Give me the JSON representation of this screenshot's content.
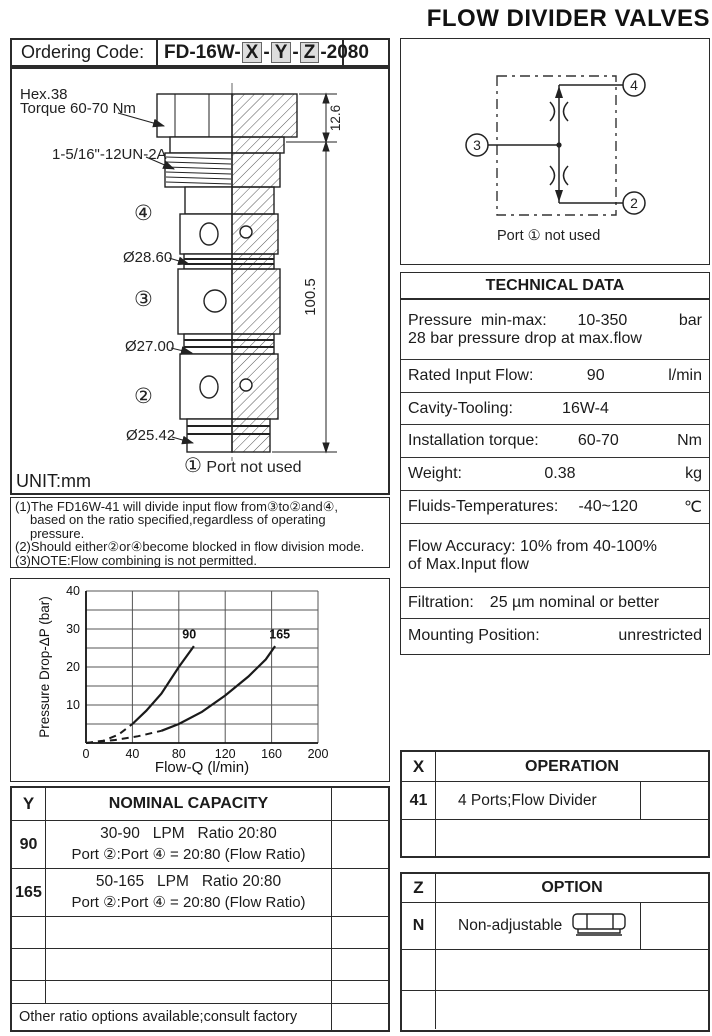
{
  "page_title": "FLOW DIVIDER VALVES",
  "ordering": {
    "label": "Ordering Code:",
    "prefix": "FD-16W-",
    "x": "X",
    "y": "Y",
    "z": "Z",
    "dash": "-",
    "suffix": "-2080"
  },
  "drawing": {
    "hex_note_1": "Hex.38",
    "hex_note_2": "Torque 60-70 Nm",
    "thread_note": "1-5/16\"-12UN-2A",
    "dim_hex_height": "12.6",
    "dim_total_height": "100.5",
    "dia_1": "Ø28.60",
    "dia_2": "Ø27.00",
    "dia_3": "Ø25.42",
    "port_4": "④",
    "port_3": "③",
    "port_2": "②",
    "port_1": "①",
    "port_1_note": "Port not used",
    "unit": "UNIT:mm"
  },
  "notes": {
    "line_1": "(1)The FD16W-41 will divide input flow from③to②and④,",
    "line_2": "based on the ratio specified,regardless of operating",
    "line_3": "pressure.",
    "line_4": "(2)Should either②or④become blocked in flow division mode.",
    "line_5": "(3)NOTE:Flow combining is not permitted."
  },
  "schematic": {
    "port_4": "4",
    "port_3": "3",
    "port_2": "2",
    "caption": "Port ①  not used"
  },
  "tech": {
    "header": "TECHNICAL DATA",
    "rows": [
      {
        "label": "Pressure  min-max:",
        "value": "10-350",
        "unit": "bar",
        "line2": "28 bar pressure drop at max.flow"
      },
      {
        "label": "Rated Input Flow:",
        "value": "90",
        "unit": "l/min"
      },
      {
        "label": "Cavity-Tooling:",
        "value": "16W-4",
        "unit": ""
      },
      {
        "label": "Installation torque:",
        "value": "60-70",
        "unit": "Nm"
      },
      {
        "label": "Weight:",
        "value": "0.38",
        "unit": "kg"
      },
      {
        "label": "Fluids-Temperatures:",
        "value": "-40~120",
        "unit": "℃"
      },
      {
        "label": "Flow Accuracy: 10% from 40-100%",
        "line2": "of Max.Input flow"
      },
      {
        "label": "Filtration:",
        "value": "25 µm nominal or better"
      },
      {
        "label": "Mounting Position:",
        "value": "unrestricted"
      }
    ]
  },
  "chart_data": {
    "type": "line",
    "title": "",
    "xlabel": "Flow-Q (l/min)",
    "ylabel": "Pressure Drop-ΔP (bar)",
    "xlim": [
      0,
      200
    ],
    "ylim": [
      0,
      40
    ],
    "x_ticks": [
      0,
      40,
      80,
      120,
      160,
      200
    ],
    "y_ticks": [
      10,
      20,
      30,
      40
    ],
    "grid_x_step": 40,
    "grid_y_step": 5,
    "grid": true,
    "legend": "inline-labels",
    "series": [
      {
        "name": "90",
        "dash_until": 40,
        "label_x": 83,
        "label_y": 27.5,
        "points": [
          [
            0,
            0
          ],
          [
            15,
            0.6
          ],
          [
            28,
            2.2
          ],
          [
            40,
            5
          ],
          [
            52,
            8.5
          ],
          [
            65,
            13
          ],
          [
            80,
            20
          ],
          [
            93,
            25.5
          ]
        ]
      },
      {
        "name": "165",
        "dash_until": 65,
        "label_x": 158,
        "label_y": 27.5,
        "points": [
          [
            0,
            0
          ],
          [
            25,
            0.8
          ],
          [
            45,
            1.8
          ],
          [
            65,
            3.2
          ],
          [
            80,
            5
          ],
          [
            100,
            8.2
          ],
          [
            120,
            12.5
          ],
          [
            140,
            17.5
          ],
          [
            155,
            22
          ],
          [
            163,
            25.5
          ]
        ]
      }
    ]
  },
  "x_table": {
    "code_header": "X",
    "title": "OPERATION",
    "rows": [
      {
        "code": "41",
        "desc": "4 Ports;Flow Divider"
      }
    ]
  },
  "y_table": {
    "code_header": "Y",
    "title": "NOMINAL CAPACITY",
    "rows": [
      {
        "code": "90",
        "line1": "30-90   LPM   Ratio 20:80",
        "line2": "Port ②:Port ④ = 20:80 (Flow Ratio)"
      },
      {
        "code": "165",
        "line1": "50-165   LPM   Ratio 20:80",
        "line2": "Port ②:Port ④ = 20:80 (Flow Ratio)"
      }
    ],
    "footer": "Other ratio options available;consult factory"
  },
  "z_table": {
    "code_header": "Z",
    "title": "OPTION",
    "rows": [
      {
        "code": "N",
        "desc": "Non-adjustable"
      }
    ]
  }
}
